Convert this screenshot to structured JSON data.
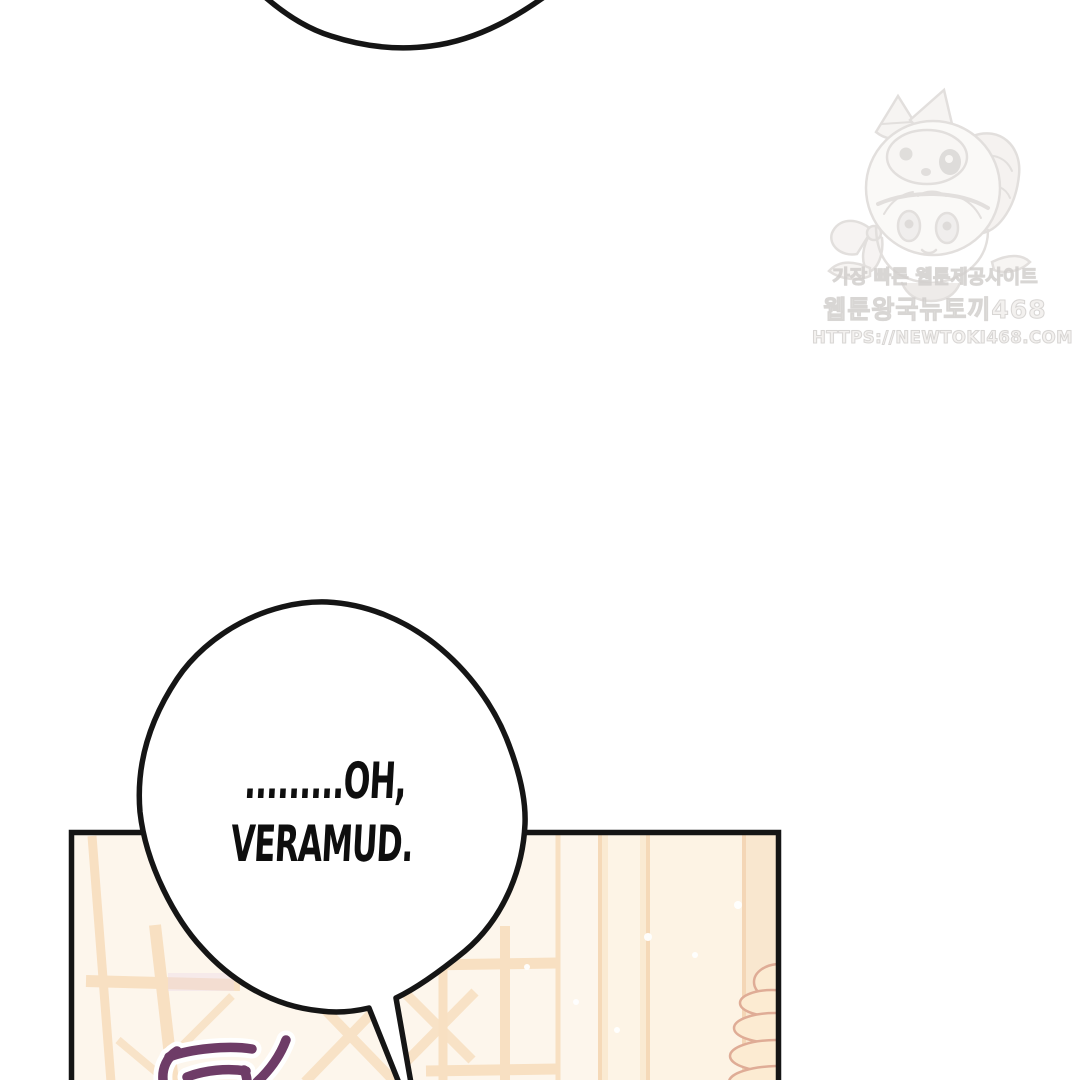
{
  "page": {
    "width": 1079,
    "height": 1080,
    "background": "#ffffff"
  },
  "main_bubble": {
    "line1": ".........OH,",
    "line2": "VERAMUD."
  },
  "watermark": {
    "line1": "가장 빠른 웹툰제공사이트",
    "line2": "웹툰왕국뉴토끼468",
    "line3": "HTTPS://NEWTOKI468.COM",
    "mascot_icon": "chibi-girl-puppy-hood-icon"
  },
  "sfx": {
    "partial_text": "탁"
  },
  "colors": {
    "panel_background": "#fdf6ec",
    "lattice": "#f8e0c2",
    "lattice_deep": "#f4d6b6",
    "outline_black": "#151515",
    "sfx_purple": "#6e3c67",
    "watermark_gray": "#d2cfcd",
    "cushion_fill": "#fcebd2",
    "cushion_outline": "#dfac96"
  }
}
